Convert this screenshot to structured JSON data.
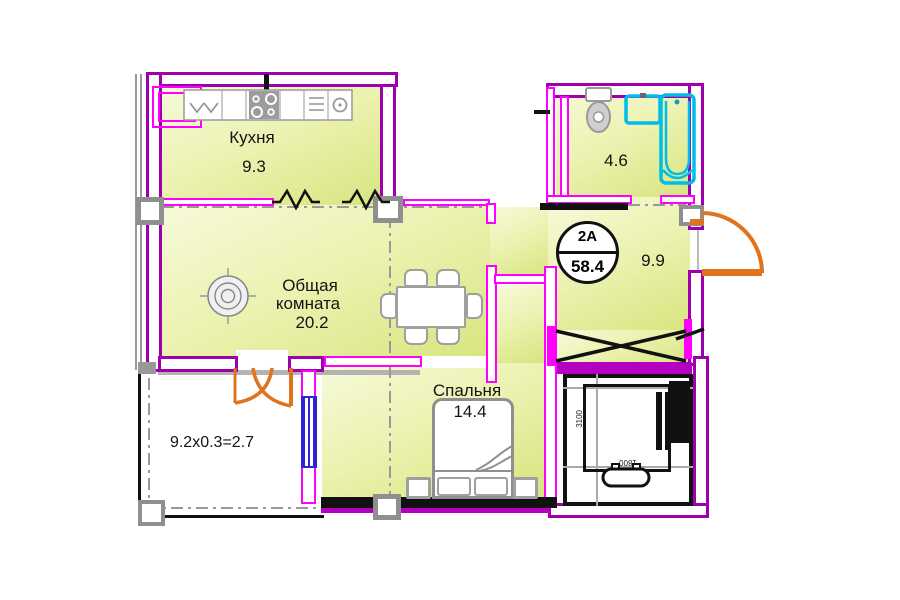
{
  "unit": {
    "type_label": "2А",
    "total_area": "58.4"
  },
  "rooms": {
    "kitchen": {
      "name": "Кухня",
      "area": "9.3"
    },
    "living": {
      "name_line1": "Общая",
      "name_line2": "комната",
      "area": "20.2"
    },
    "bedroom": {
      "name": "Спальня",
      "area": "14.4"
    },
    "bathroom": {
      "area": "4.6"
    },
    "hallway": {
      "area": "9.9"
    },
    "balcony": {
      "area_formula": "9.2x0.3=2.7"
    }
  },
  "elevator": {
    "depth_mm": "3100",
    "width_mm": "1800"
  },
  "colors": {
    "outer_wall": "#9e00ae",
    "partition": "#ff00ff",
    "room_fill": "#dfe98f",
    "door": "#e0731d",
    "window": "#2a24d8",
    "sanitary": "#00bde8",
    "furniture_gray": "#8f8f8f",
    "shaft_black": "#111111"
  }
}
